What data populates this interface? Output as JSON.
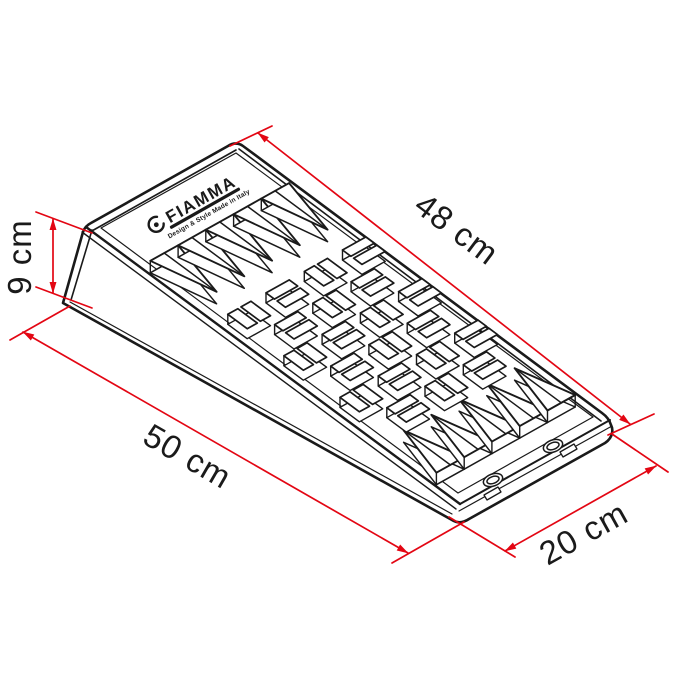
{
  "logo": {
    "brand": "FIAMMA",
    "tagline": "Design & Style Made in Italy"
  },
  "dimensions": {
    "top_length": {
      "label": "48 cm",
      "value": 48,
      "unit": "cm"
    },
    "base_length": {
      "label": "50 cm",
      "value": 50,
      "unit": "cm"
    },
    "width": {
      "label": "20 cm",
      "value": 20,
      "unit": "cm"
    },
    "height": {
      "label": "9 cm",
      "value": 9,
      "unit": "cm"
    }
  },
  "colors": {
    "dimension_red": "#e30613",
    "ink": "#1a1a1a",
    "background": "#ffffff"
  }
}
